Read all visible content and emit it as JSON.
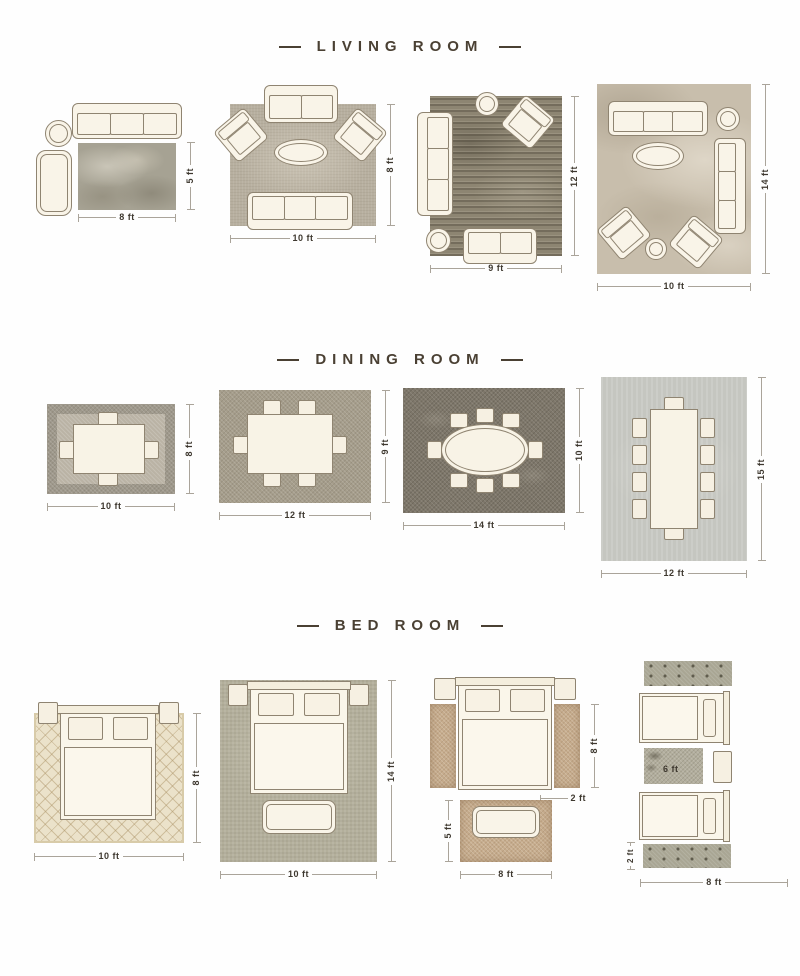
{
  "colors": {
    "title_text": "#4a4033",
    "dimension_text": "#3e382f",
    "dimension_line": "#aaa49a",
    "furniture_fill": "#f9f4e8",
    "furniture_outline": "#8f8471"
  },
  "sections": [
    {
      "title": "LIVING ROOM",
      "layouts": [
        {
          "name": "living-5x8",
          "height": "5 ft",
          "width": "8 ft"
        },
        {
          "name": "living-8x10",
          "height": "8 ft",
          "width": "10 ft"
        },
        {
          "name": "living-12x9",
          "height": "12 ft",
          "width": "9 ft"
        },
        {
          "name": "living-14x10",
          "height": "14 ft",
          "width": "10 ft"
        }
      ]
    },
    {
      "title": "DINING ROOM",
      "layouts": [
        {
          "name": "dining-8x10",
          "height": "8 ft",
          "width": "10 ft"
        },
        {
          "name": "dining-9x12",
          "height": "9 ft",
          "width": "12 ft"
        },
        {
          "name": "dining-10x14",
          "height": "10 ft",
          "width": "14 ft"
        },
        {
          "name": "dining-15x12",
          "height": "15 ft",
          "width": "12 ft"
        }
      ]
    },
    {
      "title": "BED ROOM",
      "layouts": [
        {
          "name": "bed-8x10",
          "height": "8 ft",
          "width": "10 ft"
        },
        {
          "name": "bed-14x10",
          "height": "14 ft",
          "width": "10 ft"
        },
        {
          "name": "bed-runners",
          "runner_height": "8 ft",
          "runner_width": "2 ft",
          "foot_rug_height": "5 ft",
          "foot_rug_width": "8 ft"
        },
        {
          "name": "bed-twin",
          "between_rug_width": "6 ft",
          "runner_height": "2 ft",
          "width": "8 ft"
        }
      ]
    }
  ]
}
